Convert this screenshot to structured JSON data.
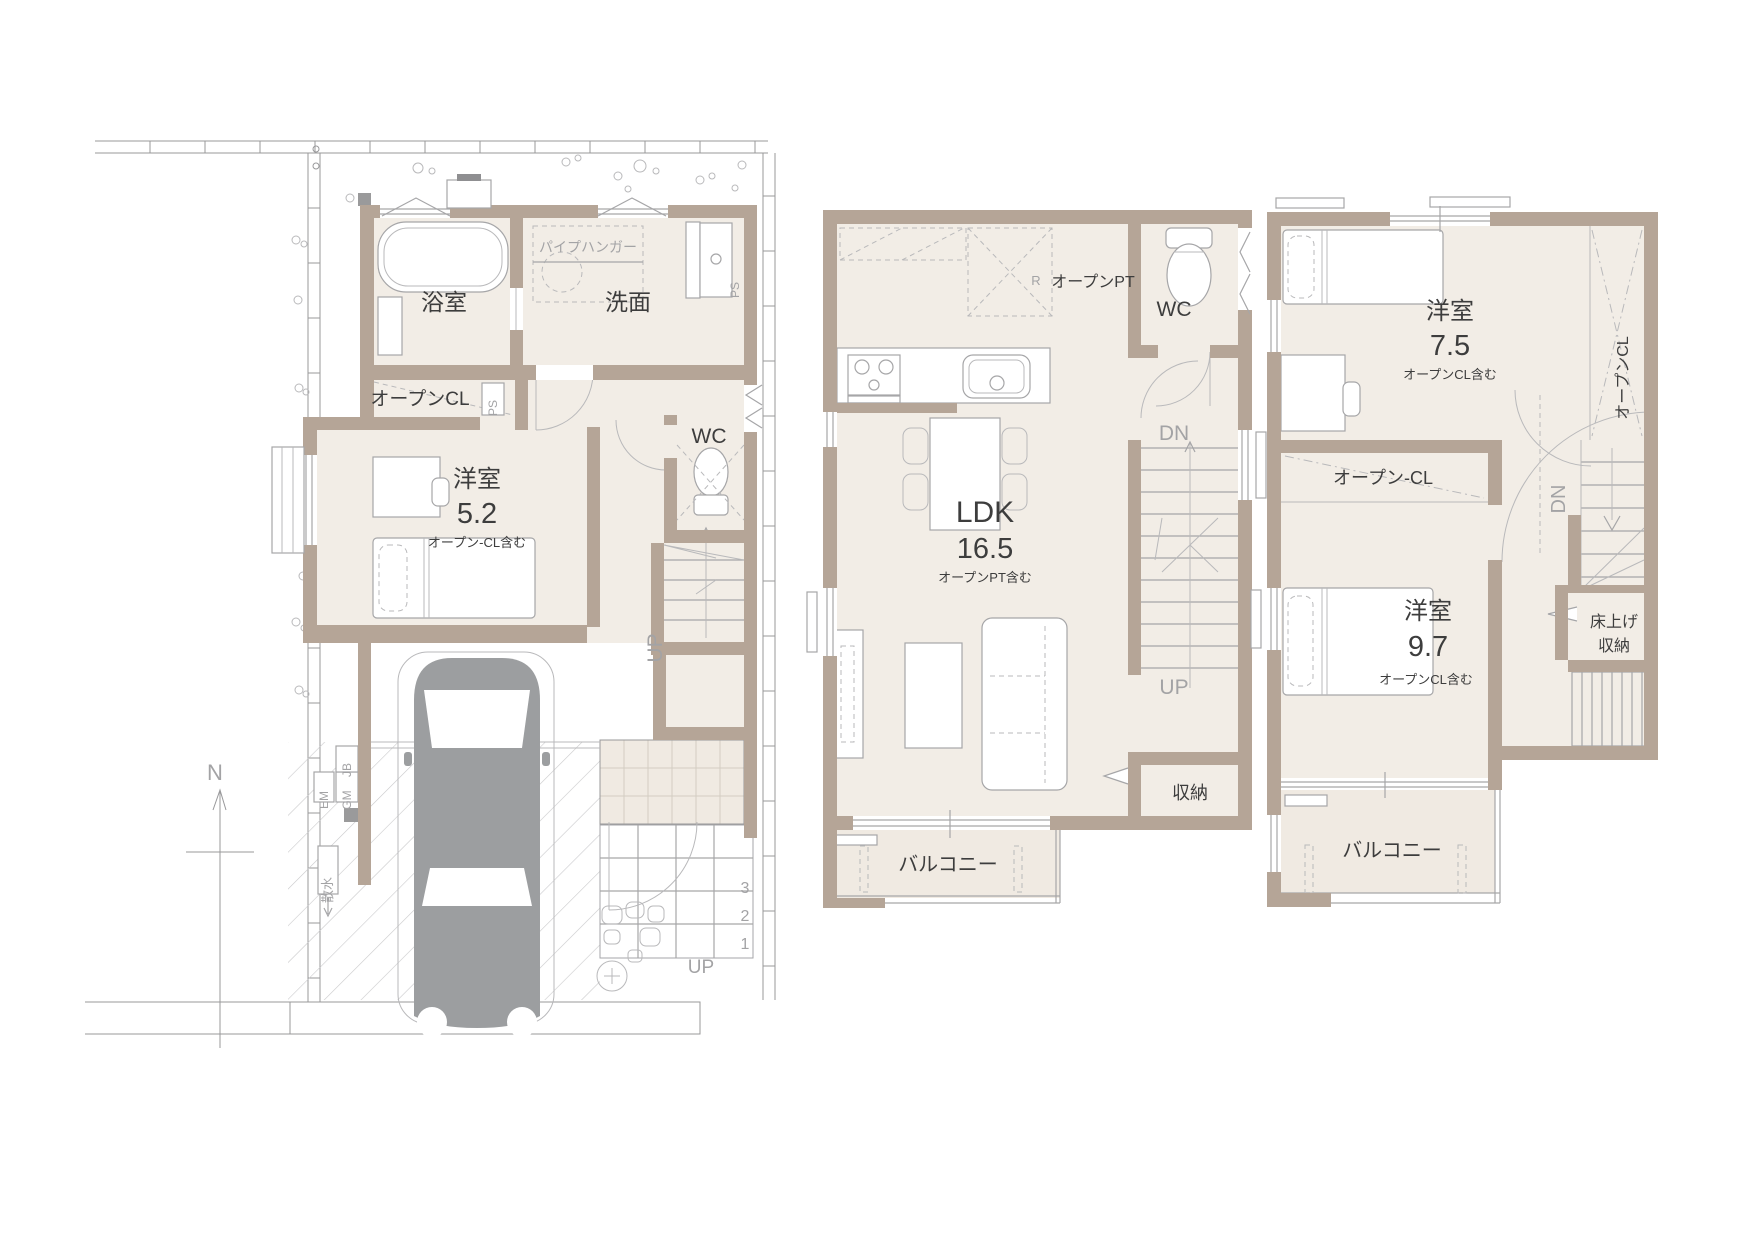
{
  "drawing_title": "3-story house floor plans (1F / 2F / 3F)",
  "colors": {
    "wall": "#b5a597",
    "floor": "#f2ede6",
    "tile": "#f0eae2",
    "line": "#a6a6a8",
    "boundary": "#98989a",
    "car": "#9c9ea0",
    "text_dark": "#3d3d3d",
    "text_gray": "#a3a3a5"
  },
  "floor1": {
    "bath": "浴室",
    "washroom": "洗面",
    "pipe_hanger": "パイプハンガー",
    "open_cl": "オープンCL",
    "ps_shaft": "PS",
    "ps_washroom": "PS",
    "room": "洋室",
    "room_size": "5.2",
    "room_note": "オープン-CL含む",
    "wc": "WC",
    "stair_up": "UP",
    "entrance_up": "UP",
    "steps": [
      "3",
      "2",
      "1"
    ],
    "meter_em": "EM",
    "meter_gm": "GM",
    "meter_jb": "JB",
    "sprinkler": "散水",
    "north": "N"
  },
  "floor2": {
    "fridge": "R",
    "open_pt": "オープンPT",
    "wc": "WC",
    "dn": "DN",
    "up": "UP",
    "ldk": "LDK",
    "ldk_size": "16.5",
    "ldk_note": "オープンPT含む",
    "storage": "収納",
    "balcony": "バルコニー"
  },
  "floor3": {
    "room1": "洋室",
    "room1_size": "7.5",
    "room1_note": "オープンCL含む",
    "open_cl_side": "オープンCL",
    "open_cl_band": "オープン-CL",
    "room2": "洋室",
    "room2_size": "9.7",
    "room2_note": "オープンCL含む",
    "dn": "DN",
    "raised_storage_1": "床上げ",
    "raised_storage_2": "収納",
    "balcony": "バルコニー"
  }
}
